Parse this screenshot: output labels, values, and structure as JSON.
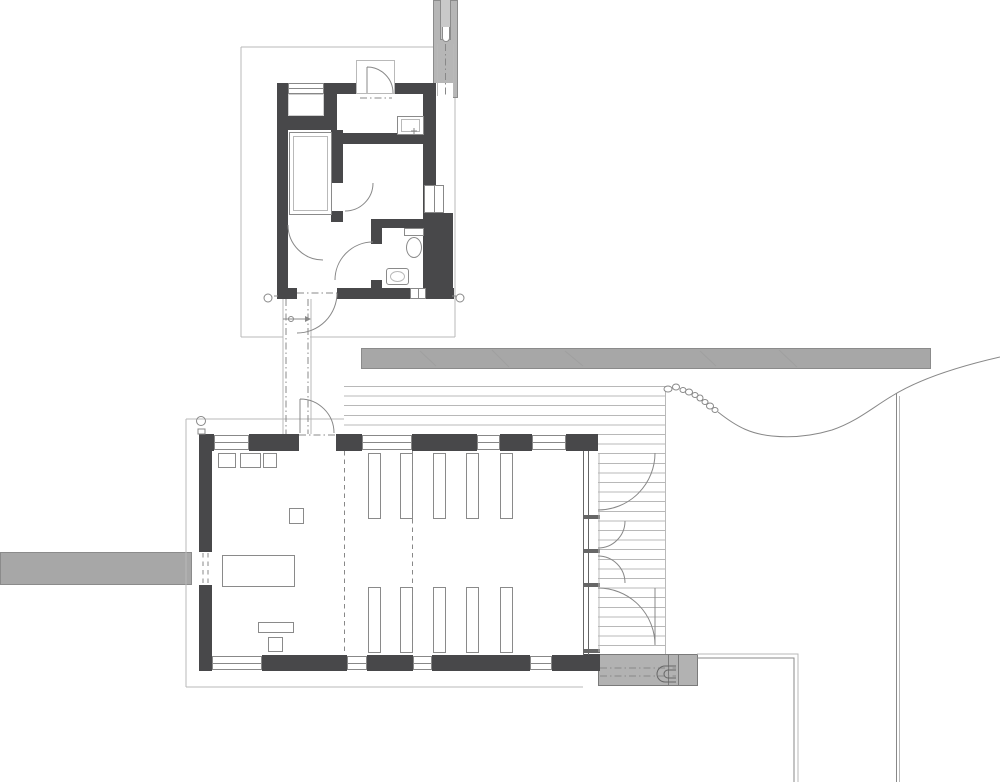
{
  "title": "Site floor plan — cabin and chapel hall with deck",
  "colors": {
    "wall": "#48484a",
    "line": "#888888",
    "line_dark": "#666666",
    "line_light": "#b9b9b9",
    "deck_line": "#b8b8b8",
    "bar_fill": "#a7a7a7",
    "bar_border": "#8b8b8b",
    "chimney": "#b6b6b6",
    "steps": "#b2b2b2",
    "furn": "#8a8a8a",
    "bg": "#ffffff"
  },
  "plan": {
    "buildings": 2,
    "upper_building": {
      "rooms": 5,
      "fixtures": [
        "bed",
        "stove",
        "toilet",
        "sink",
        "closet-niche"
      ],
      "doors": 6,
      "chimney": 1
    },
    "lower_building": {
      "pew_benches": 10,
      "glazed_doors": 4,
      "fixtures": [
        "cabinet-boxes",
        "table",
        "lectern",
        "bench"
      ],
      "windows": 8
    },
    "site": [
      "north-path-slab",
      "west-path-slab",
      "wood-deck",
      "stone-row",
      "terrain-contour",
      "steps"
    ]
  }
}
